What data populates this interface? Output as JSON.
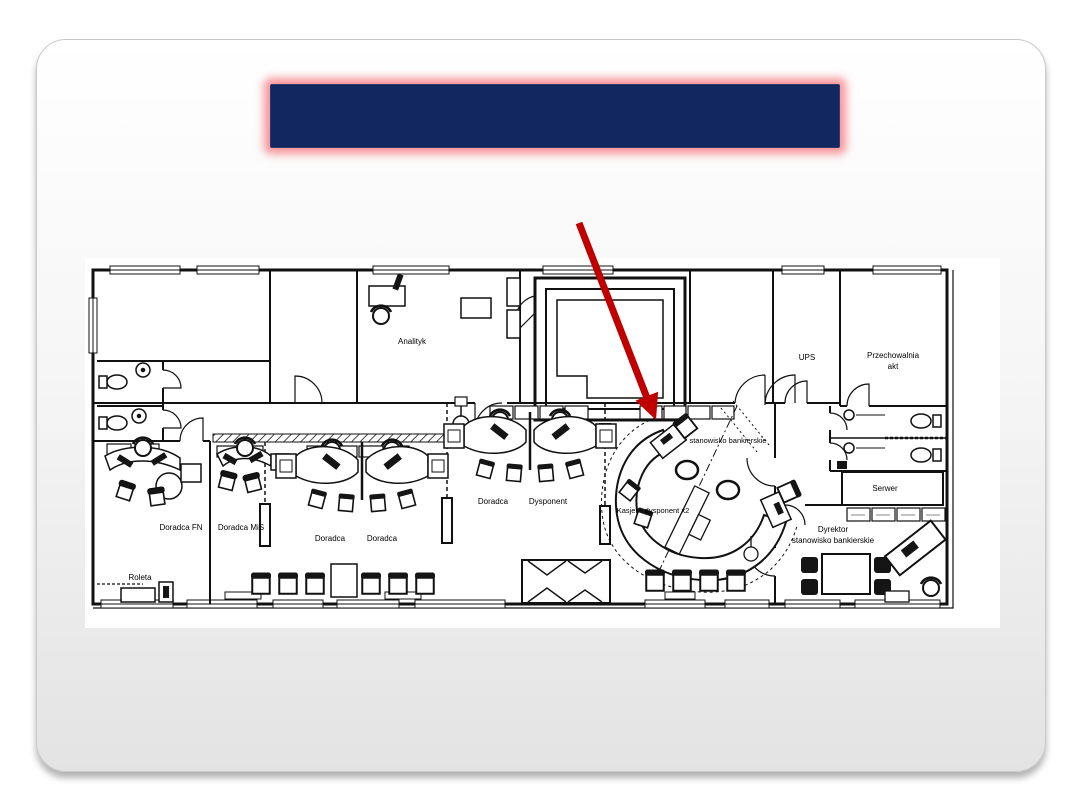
{
  "title_bar": {
    "text": "",
    "fill": "#12275e",
    "glow_color": "#f6787d"
  },
  "floor_plan": {
    "arrow_color": "#c00000",
    "labels": {
      "analityk": "Analityk",
      "ups": "UPS",
      "przechowalnia_line1": "Przechowalnia",
      "przechowalnia_line2": "akt",
      "serwer": "Serwer",
      "doradca_fn": "Doradca FN",
      "doradca_mis": "Doradca MiS",
      "doradca_1": "Doradca",
      "doradca_2": "Doradca",
      "doradca_3": "Doradca",
      "dysponent": "Dysponent",
      "stanowisko_bankierskie": "stanowisko bankierskie",
      "kasjer": "Kasjer - dysponent x2",
      "dyrektor_line1": "Dyrektor",
      "dyrektor_line2": "stanowisko bankierskie",
      "roleta": "Roleta"
    }
  }
}
